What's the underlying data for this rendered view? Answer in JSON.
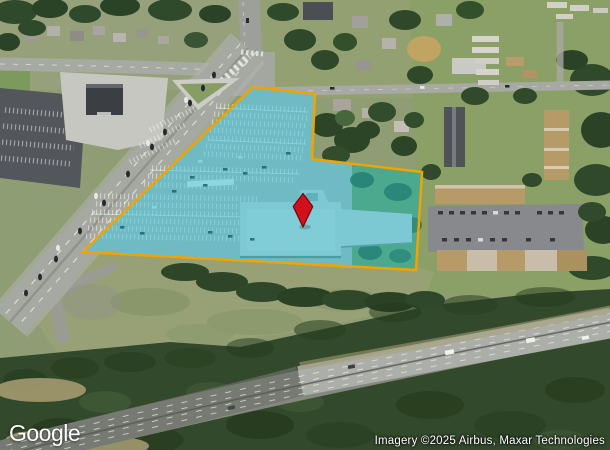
{
  "map": {
    "view_type": "satellite",
    "provider": "Google",
    "attribution": "Imagery ©2025 Airbus, Maxar Technologies",
    "parcel_overlay": {
      "points": "253,87 315,94 312,159 422,172 416,270 83,252",
      "fill_color": "#00b7d4",
      "fill_opacity": "0.40",
      "border_color": "#f0a400",
      "border_width": "2.5"
    },
    "marker": {
      "shape_path": "M303,193.5 L312.7,206.5 L303,227 L293.3,206.5 Z",
      "fill_color": "#d40f1d",
      "border_color": "#7e0406",
      "center_x": "303",
      "center_y": "210"
    }
  }
}
